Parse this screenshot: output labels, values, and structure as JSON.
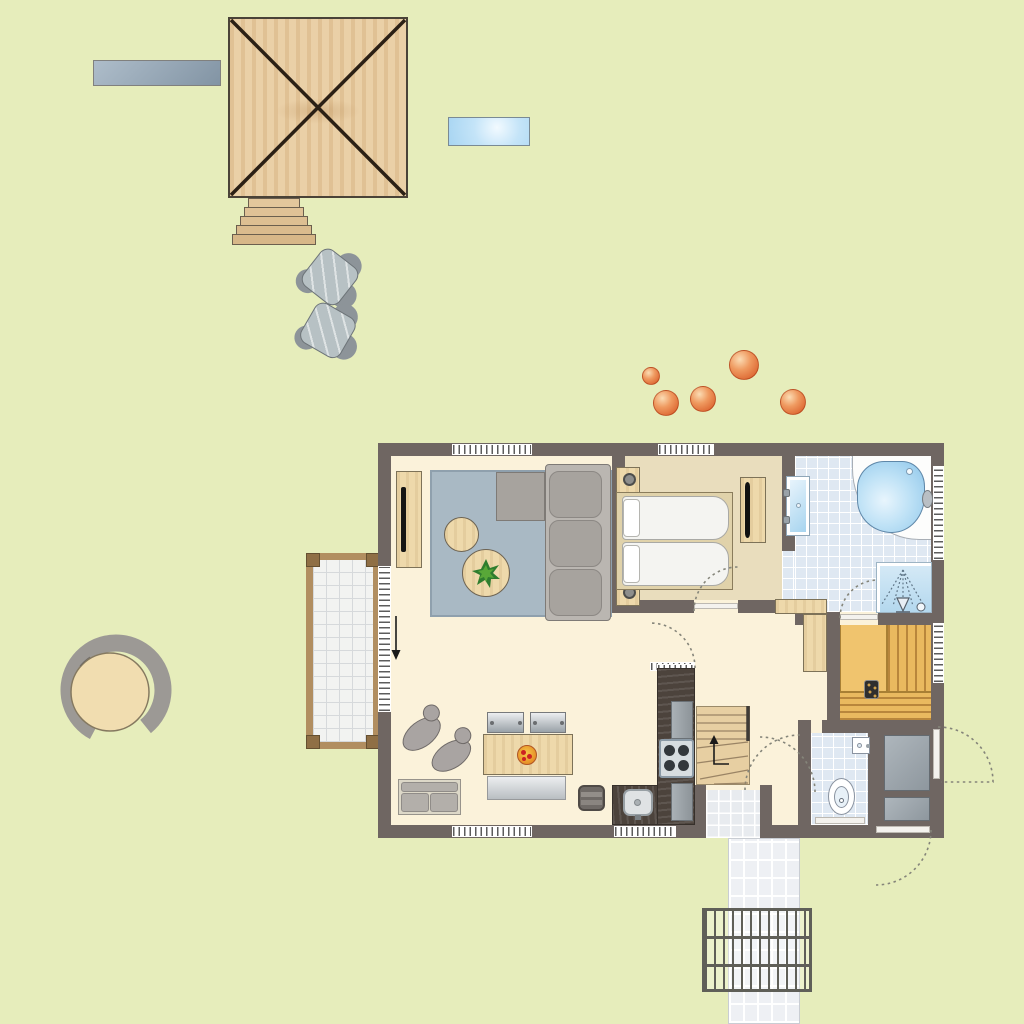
{
  "scene": {
    "type": "holiday-home-floor-plan",
    "description": "top-down architectural floor plan of a bungalow with garden, play platform, terrace and entrance path",
    "text_labels": []
  },
  "colors": {
    "bg": "#e6edbb",
    "wall": "#6f6662",
    "floor": "#fbf2da",
    "bedroomFloor": "#e9ddbd",
    "tile": "#dfe8f2",
    "wood": "#eed9ab",
    "rug": "#a9b9c4",
    "sauna": "#f0c46e",
    "saunaSlat": "#b8863c",
    "counter": "#4c433c",
    "waterBlue": "#a6d4ef",
    "grayFurniture": "#a7a39e",
    "arcDotted": "#85857a",
    "ballOrange": "#d5521f",
    "pathTile": "#eef0f4",
    "terraceFrame": "#b18e60"
  },
  "outdoor": {
    "items": [
      {
        "name": "garden-bench"
      },
      {
        "name": "wooden-play-platform"
      },
      {
        "name": "platform-stairs"
      },
      {
        "name": "garden-chair",
        "count": 2
      },
      {
        "name": "blue-bench"
      },
      {
        "name": "round-tree-seat"
      },
      {
        "name": "terrace-deck"
      },
      {
        "name": "entrance-path"
      },
      {
        "name": "foot-grate"
      },
      {
        "name": "shrub-ball",
        "count": 5
      }
    ],
    "shrub_balls": [
      {
        "x": 651,
        "y": 376,
        "r": 9
      },
      {
        "x": 666,
        "y": 403,
        "r": 13
      },
      {
        "x": 703,
        "y": 399,
        "r": 13
      },
      {
        "x": 744,
        "y": 365,
        "r": 15
      },
      {
        "x": 793,
        "y": 402,
        "r": 13
      }
    ]
  },
  "house": {
    "rooms": [
      {
        "name": "living-dining-room",
        "fixtures": [
          "corner-sofa",
          "rug",
          "tv-cabinet",
          "coffee-tables",
          "plant",
          "dining-table",
          "dining-chairs",
          "dining-bench",
          "lounge-chairs",
          "loveseat",
          "stool",
          "sliding-terrace-door"
        ]
      },
      {
        "name": "kitchen",
        "fixtures": [
          "counter",
          "cooktop",
          "sink",
          "appliances"
        ]
      },
      {
        "name": "bedroom",
        "fixtures": [
          "double-bed",
          "pillows",
          "nightstand-with-lamp",
          "dresser-with-tv",
          "window"
        ]
      },
      {
        "name": "bathroom",
        "fixtures": [
          "corner-bathtub",
          "double-washbasin",
          "round-washbasin",
          "shower",
          "door"
        ]
      },
      {
        "name": "sauna",
        "fixtures": [
          "bench-slats",
          "heater"
        ]
      },
      {
        "name": "toilet-room",
        "fixtures": [
          "toilet",
          "hand-basin"
        ]
      },
      {
        "name": "storage-room",
        "fixtures": [
          "storage-unit",
          "exterior-doors"
        ]
      },
      {
        "name": "hallway",
        "fixtures": [
          "winder-staircase",
          "door-arcs"
        ]
      },
      {
        "name": "entrance-porch",
        "fixtures": [
          "tiled-floor"
        ]
      }
    ]
  }
}
